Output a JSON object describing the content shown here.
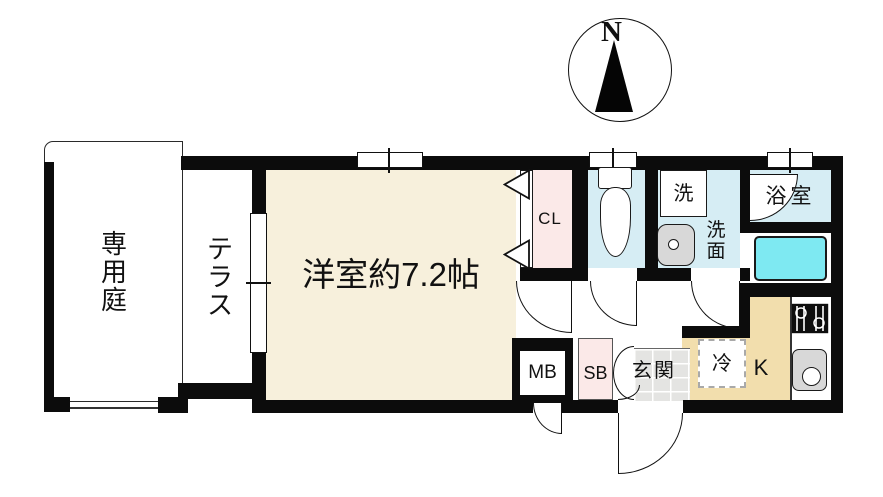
{
  "compass": {
    "north_label": "N"
  },
  "labels": {
    "garden": "専用庭",
    "terrace": "テラス",
    "main_room": "洋室約7.2帖",
    "closet": "CL",
    "washer": "洗",
    "washroom": "洗面",
    "bathroom": "浴室",
    "entrance": "玄関",
    "kitchen": "K",
    "refrigerator": "冷",
    "shoe_box": "SB",
    "meter_box": "MB"
  },
  "colors": {
    "wall": "#0c0c0c",
    "main_room_floor": "#f7f0dc",
    "closet_floor": "#fbe9e8",
    "shoe_box_floor": "#fbe9e8",
    "wet_area_floor": "#d6edf4",
    "bathtub": "#7ee9f2",
    "kitchen_floor": "#f2dead",
    "entrance_tile": "#e4e4e2",
    "fixture_gray": "#d8d8d8"
  }
}
